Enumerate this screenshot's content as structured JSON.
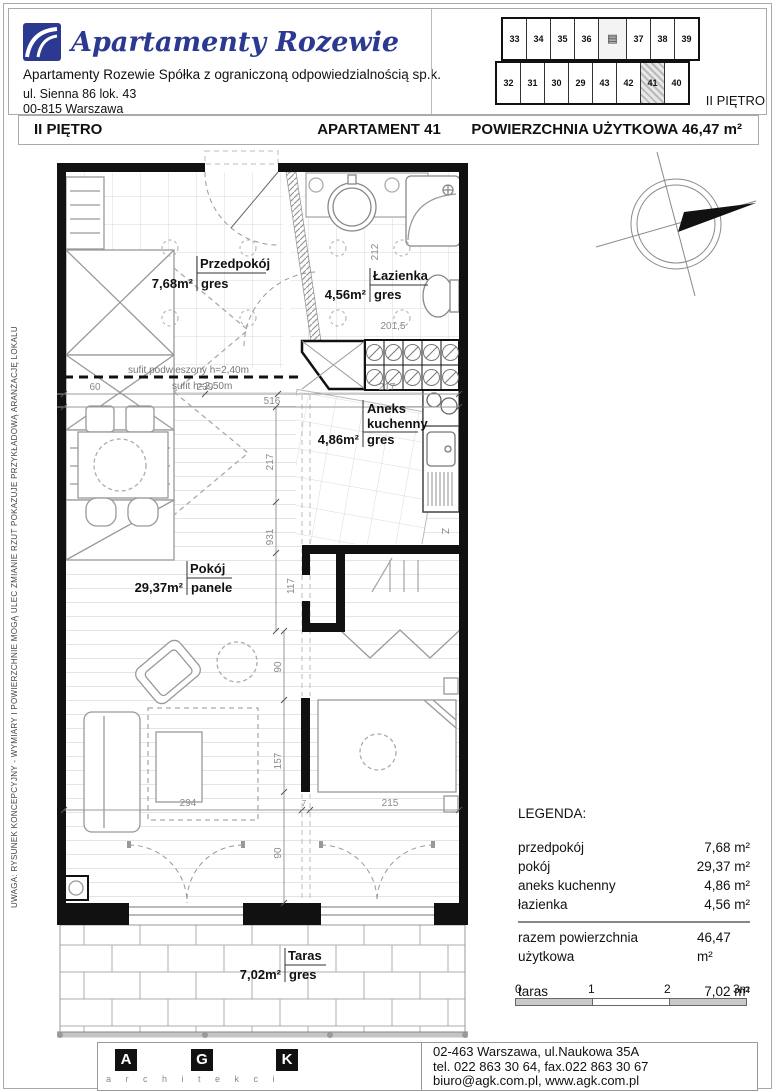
{
  "header": {
    "logo_text": "Apartamenty Rozewie",
    "company": "Apartamenty Rozewie Spółka z ograniczoną odpowiedzialnością sp.k.",
    "address_line1": "ul. Sienna 86 lok. 43",
    "address_line2": "00-815 Warszawa",
    "miniplan": {
      "floor_label": "II PIĘTRO",
      "top_row": [
        "33",
        "34",
        "35",
        "36",
        "37",
        "38",
        "39"
      ],
      "bottom_row": [
        "32",
        "31",
        "30",
        "29",
        "43",
        "42",
        "41",
        "40"
      ],
      "highlighted_unit": "41",
      "core_icon": "▤"
    }
  },
  "title_bar": {
    "floor": "II PIĘTRO",
    "apartment": "APARTAMENT 41",
    "area": "POWIERZCHNIA UŻYTKOWA 46,47 m²"
  },
  "side_note": "UWAGA:  RYSUNEK KONCEPCYJNY - WYMIARY I POWIERZCHNIE MOGĄ ULEC ZMIANIE   RZUT POKAZUJE PRZYKŁADOWĄ ARANŻACJĘ LOKALU",
  "plan": {
    "rooms": {
      "przedpokoj": {
        "name": "Przedpokój",
        "area": "7,68m²",
        "floor": "gres"
      },
      "lazienka": {
        "name": "Łazienka",
        "area": "4,56m²",
        "floor": "gres"
      },
      "aneks": {
        "name1": "Aneks",
        "name2": "kuchenny",
        "area": "4,86m²",
        "floor": "gres"
      },
      "pokoj": {
        "name": "Pokój",
        "area": "29,37m²",
        "floor": "panele"
      },
      "taras": {
        "name": "Taras",
        "area": "7,02m²",
        "floor": "gres"
      }
    },
    "ceiling_notes": {
      "suspended": "sufit podwieszony h=2,40m",
      "normal": "sufit h=2,50m"
    },
    "fridge_label": "Z",
    "dims": {
      "top_60": "60",
      "top_239": "239",
      "top_516": "516",
      "top_217": "217",
      "bath_212": "212",
      "bath_2015": "201,5",
      "mid_217": "217",
      "mid_931": "931",
      "mid_117": "117",
      "v90a": "90",
      "v157": "157",
      "v90b": "90",
      "b294": "294",
      "b215": "215",
      "b7": "7"
    }
  },
  "legend": {
    "title": "LEGENDA:",
    "rows": [
      {
        "label": "przedpokój",
        "value": "7,68 m²"
      },
      {
        "label": "pokój",
        "value": "29,37 m²"
      },
      {
        "label": "aneks kuchenny",
        "value": "4,86 m²"
      },
      {
        "label": "łazienka",
        "value": "4,56 m²"
      }
    ],
    "total": {
      "label": "razem powierzchnia użytkowa",
      "value": "46,47 m²"
    },
    "taras": {
      "label": "taras",
      "value": "7,02 m²"
    }
  },
  "scale_bar": {
    "labels": [
      "0",
      "1",
      "2",
      "3m"
    ]
  },
  "footer": {
    "logo_letters": [
      "A",
      "G",
      "K"
    ],
    "logo_sub": "a r c h i t e k c i",
    "address": "02-463 Warszawa, ul.Naukowa 35A",
    "phone": "tel. 022 863 30 64, fax.022 863 30 67",
    "web": "biuro@agk.com.pl, www.agk.com.pl"
  },
  "colors": {
    "logo_blue": "#2b3990",
    "wall_black": "#111111",
    "furniture_gray": "#999999",
    "tile_gray": "#d9d9d9",
    "dim_gray": "#8a8a8a"
  }
}
